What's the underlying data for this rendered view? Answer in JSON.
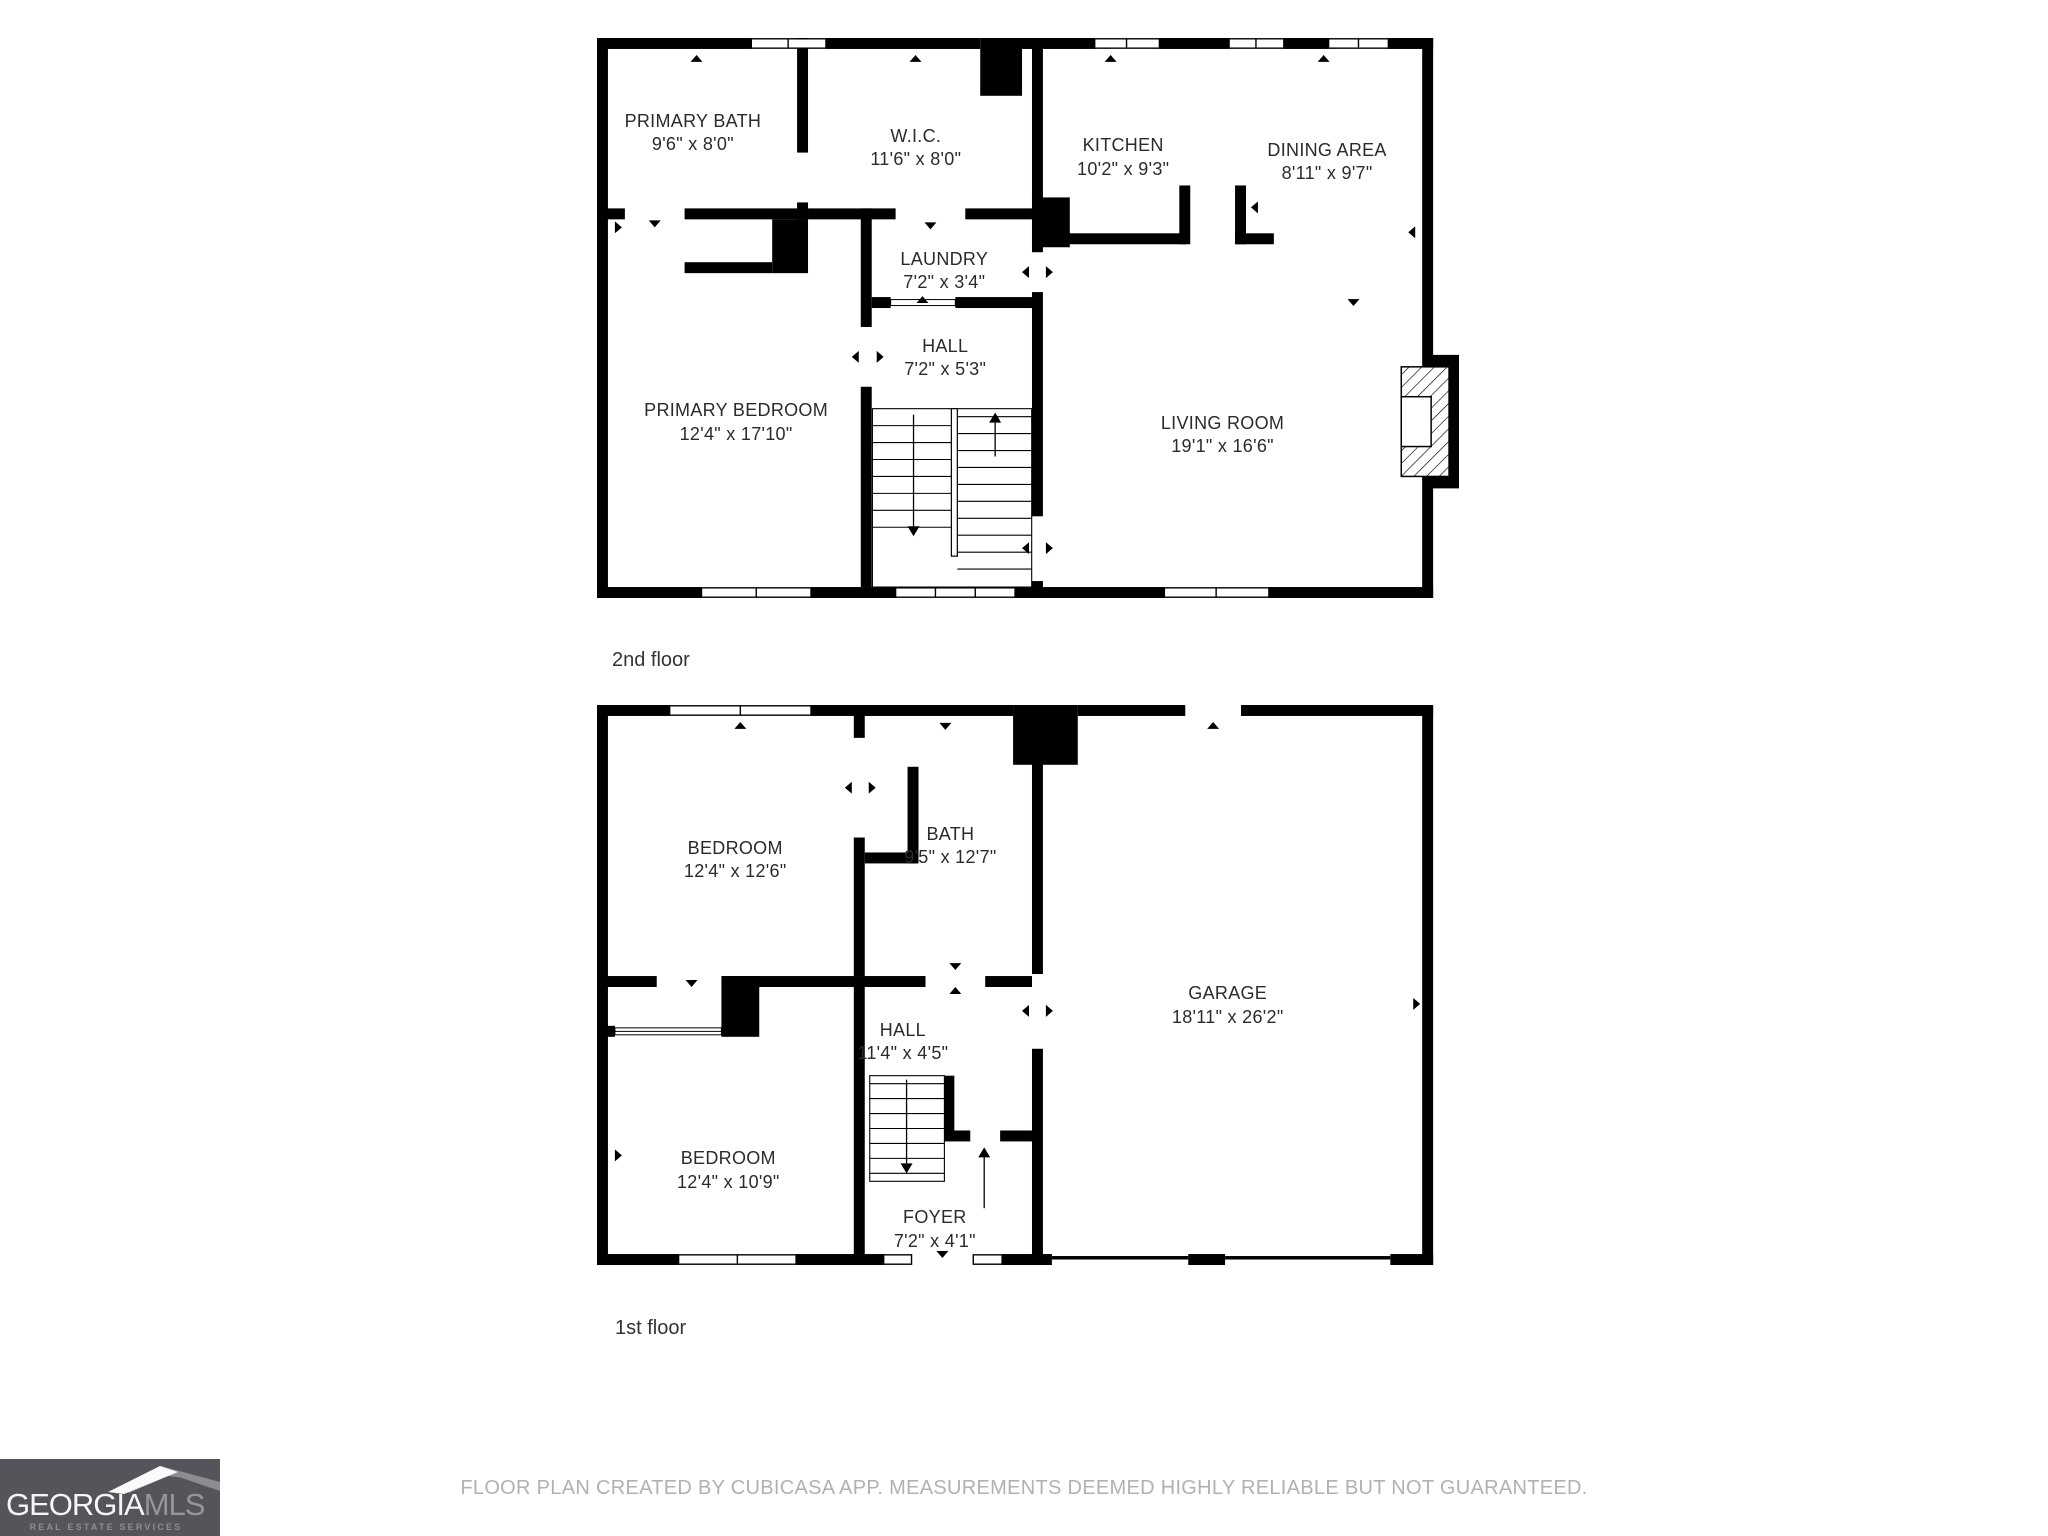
{
  "floors": [
    {
      "label": "2nd floor",
      "rooms": [
        {
          "name": "PRIMARY BATH",
          "dims": "9'6\" x 8'0\""
        },
        {
          "name": "W.I.C.",
          "dims": "11'6\" x 8'0\""
        },
        {
          "name": "KITCHEN",
          "dims": "10'2\" x 9'3\""
        },
        {
          "name": "DINING AREA",
          "dims": "8'11\" x 9'7\""
        },
        {
          "name": "LAUNDRY",
          "dims": "7'2\" x 3'4\""
        },
        {
          "name": "HALL",
          "dims": "7'2\" x 5'3\""
        },
        {
          "name": "PRIMARY BEDROOM",
          "dims": "12'4\" x 17'10\""
        },
        {
          "name": "LIVING ROOM",
          "dims": "19'1\" x 16'6\""
        }
      ]
    },
    {
      "label": "1st floor",
      "rooms": [
        {
          "name": "BEDROOM",
          "dims": "12'4\" x 12'6\""
        },
        {
          "name": "BATH",
          "dims": "9'5\" x 12'7\""
        },
        {
          "name": "GARAGE",
          "dims": "18'11\" x 26'2\""
        },
        {
          "name": "HALL",
          "dims": "11'4\" x 4'5\""
        },
        {
          "name": "BEDROOM",
          "dims": "12'4\" x 10'9\""
        },
        {
          "name": "FOYER",
          "dims": "7'2\" x 4'1\""
        }
      ]
    }
  ],
  "footer": {
    "disclaimer": "FLOOR PLAN CREATED BY CUBICASA APP. MEASUREMENTS DEEMED HIGHLY RELIABLE BUT NOT GUARANTEED."
  },
  "logo": {
    "brand_primary": "GEORGIA",
    "brand_secondary": "MLS",
    "tagline": "REAL ESTATE SERVICES"
  },
  "colors": {
    "wall": "#000000",
    "room_label": "#2b2b2b",
    "floor_label": "#333333",
    "disclaimer": "#b3b0b0",
    "logo_bg": "#56535b",
    "logo_mls": "#97949c",
    "logo_tagline": "#8f8c94"
  }
}
